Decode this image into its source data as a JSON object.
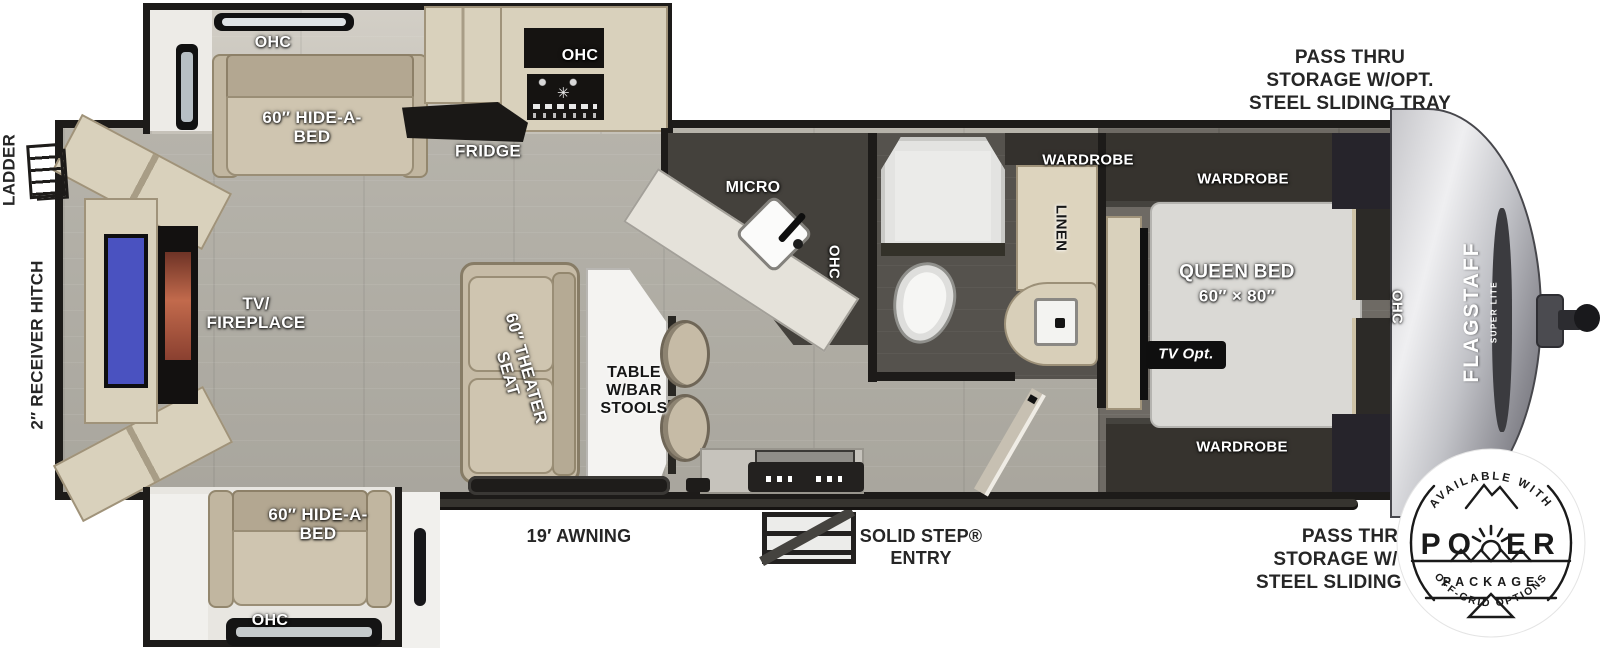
{
  "exterior": {
    "pass_thru_top": "PASS THRU\nSTORAGE W/OPT.\nSTEEL SLIDING TRAY",
    "pass_thru_bottom": "PASS THRU\nSTORAGE W/OPT.\nSTEEL SLIDING TRAY",
    "ladder": "LADDER",
    "receiver_hitch": "2″ RECEIVER HITCH",
    "awning": "19′ AWNING",
    "solid_step": "SOLID STEP®\nENTRY"
  },
  "living": {
    "ohc_slide_top": "OHC",
    "hide_a_bed_top": "60″ HIDE-A-\nBED",
    "fridge": "FRIDGE",
    "ohc_stove": "OHC",
    "tv_fireplace": "TV/\nFIREPLACE",
    "theater_seat": "60″ THEATER\nSEAT",
    "table": "TABLE\nW/BAR\nSTOOLS",
    "hide_a_bed_bottom": "60″ HIDE-A-\nBED",
    "ohc_slide_bottom": "OHC"
  },
  "kitchen": {
    "micro": "MICRO",
    "ohc": "OHC"
  },
  "bath": {
    "wardrobe": "WARDROBE",
    "linen": "LINEN"
  },
  "bedroom": {
    "wardrobe_top": "WARDROBE",
    "wardrobe_bottom": "WARDROBE",
    "queen_bed": "QUEEN BED",
    "queen_bed_size": "60″ × 80″",
    "tv_opt": "TV Opt.",
    "ohc": "OHC"
  },
  "brand": {
    "name": "FLAGSTAFF",
    "sub": "SUPER LITE"
  },
  "badge": {
    "top": "AVAILABLE WITH",
    "power_po": "PO",
    "power_er": "ER",
    "package": "PACKAGE",
    "bottom": "OFF-GRID OPTIONS"
  },
  "icons": {
    "burner": "✳"
  },
  "colors": {
    "tv_screen_blue": "#4a52c0",
    "fireplace_glow": "#c26a4c",
    "wall_dark": "#1d1b19",
    "wood_cabinet": "#d9d1bc",
    "sofa_tan": "#cfc5b0",
    "badge_ink": "#1a1a1a"
  }
}
